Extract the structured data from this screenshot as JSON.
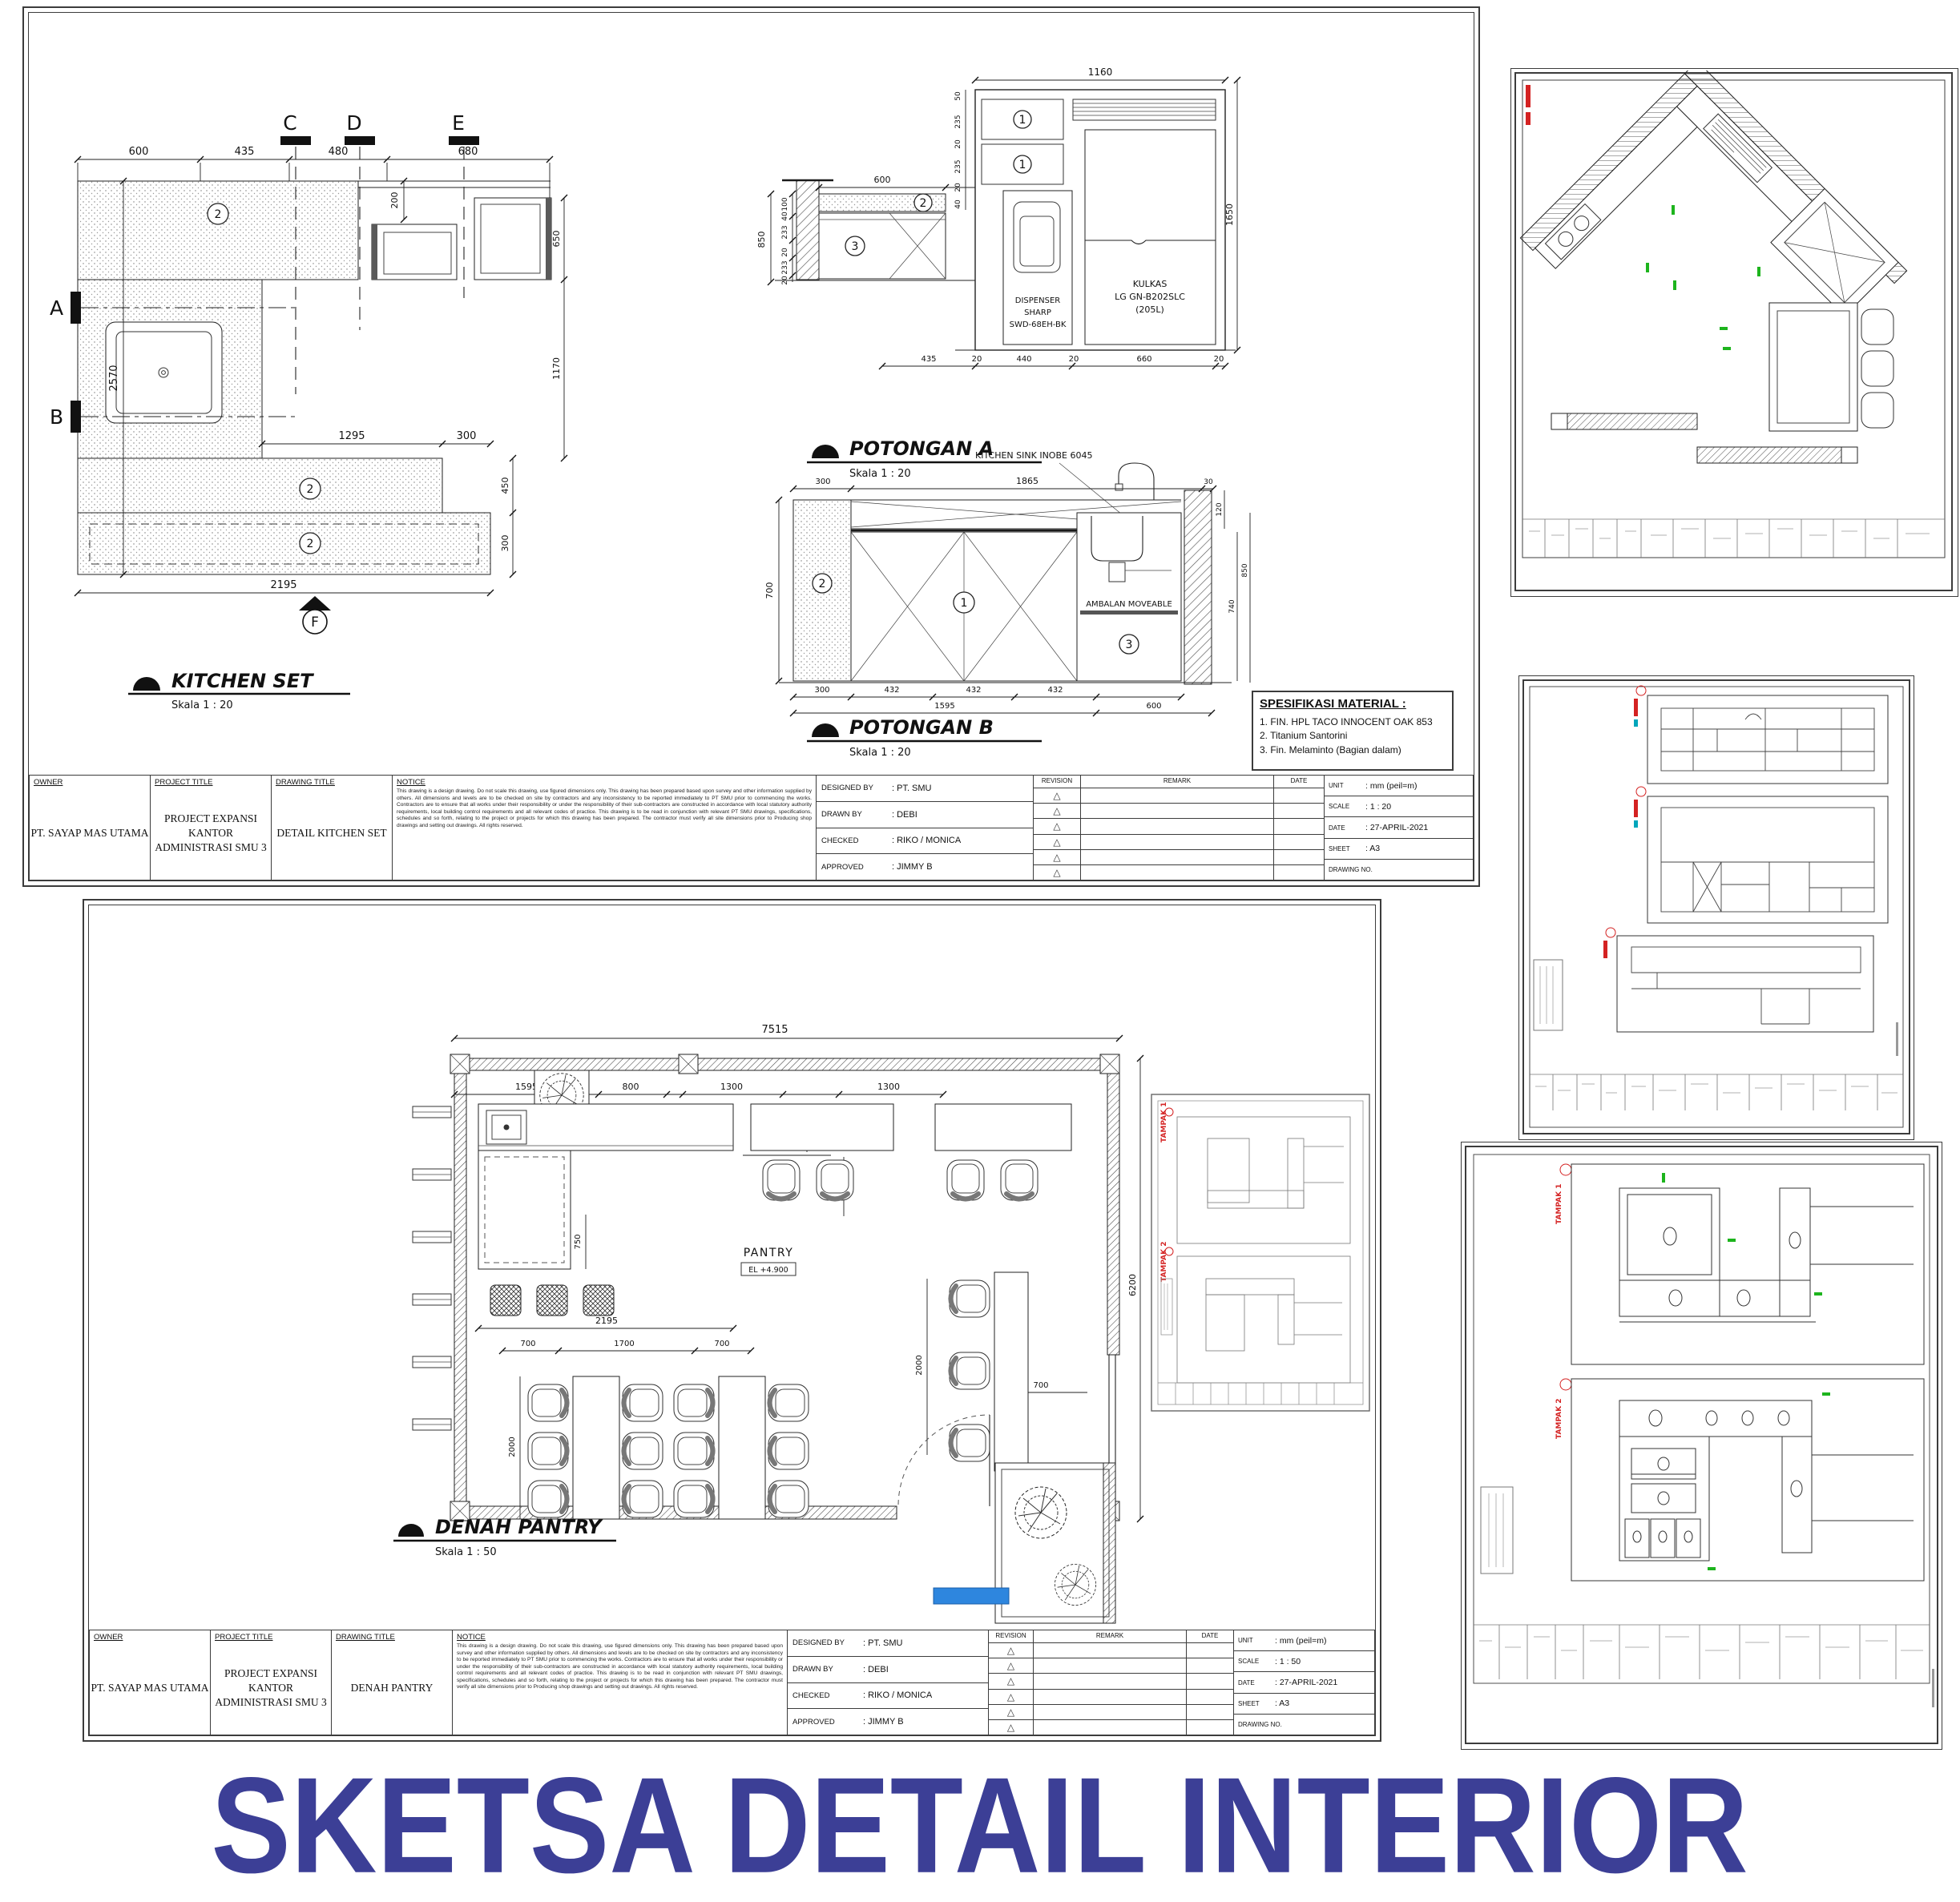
{
  "page": {
    "main_title": "SKETSA DETAIL INTERIOR"
  },
  "titleblock": {
    "labels": {
      "owner": "OWNER",
      "project_title": "PROJECT TITLE",
      "drawing_title": "DRAWING TITLE",
      "notice": "NOTICE",
      "designed_by": "DESIGNED BY",
      "drawn_by": "DRAWN BY",
      "checked": "CHECKED",
      "approved": "APPROVED",
      "revision": "REVISION",
      "remark": "REMARK",
      "date": "DATE",
      "unit": "UNIT",
      "scale": "SCALE",
      "sheet": "SHEET",
      "drawing_no": "DRAWING NO."
    },
    "owner": "PT. SAYAP MAS UTAMA",
    "project_line1": "PROJECT EXPANSI",
    "project_line2": "KANTOR ADMINISTRASI SMU 3",
    "designed_by": ": PT. SMU",
    "drawn_by": ": DEBI",
    "checked": ": RIKO / MONICA",
    "approved": ": JIMMY B",
    "unit_value": ": mm (peil=m)",
    "date_value": ": 27-APRIL-2021",
    "sheet_value": ": A3",
    "notice_text": "This drawing is a design drawing. Do not scale this drawing, use figured dimensions only. This drawing has been prepared based upon survey and other information supplied by others. All dimensions and levels are to be checked on site by contractors and any inconsistency to be reported immediately to PT SMU prior to commencing the works. Contractors are to ensure that all works under their responsibility or under the responsibility of their sub-contractors are constructed in accordance with local statutory authority requirements, local building control requirements and all relevant codes of practice. This drawing is to be read in conjunction with relevant PT SMU drawings, specifications, schedules and so forth, relating to the project or projects for which this drawing has been prepared. The contractor must verify all site dimensions prior to Producing shop drawings and setting out drawings. All rights reserved."
  },
  "sheet1": {
    "drawing_title": "DETAIL KITCHEN SET",
    "scale_value": ": 1 : 20",
    "kitchen": {
      "title": "KITCHEN SET",
      "scale": "Skala 1 : 20",
      "dim_600": "600",
      "dim_435": "435",
      "dim_480": "480",
      "dim_680": "680",
      "dim_200": "200",
      "dim_650": "650",
      "dim_1170": "1170",
      "dim_2570": "2570",
      "dim_1295": "1295",
      "dim_300a": "300",
      "dim_450": "450",
      "dim_300b": "300",
      "dim_2195": "2195",
      "mk_a": "A",
      "mk_b": "B",
      "mk_c": "C",
      "mk_d": "D",
      "mk_e": "E",
      "mk_f": "F",
      "tag2": "2"
    },
    "pot_a": {
      "title": "POTONGAN A",
      "scale": "Skala 1 : 20",
      "dim_1160": "1160",
      "dim_1650": "1650",
      "dim_600": "600",
      "dim_435": "435",
      "stack_left": [
        "100",
        "40",
        "233",
        "20",
        "233",
        "20"
      ],
      "dim_850": "850",
      "stack_right": [
        "50",
        "235",
        "20",
        "235",
        "20",
        "40"
      ],
      "bottom": [
        "435",
        "20",
        "440",
        "20",
        "660",
        "20"
      ],
      "tag1": "1",
      "tag2": "2",
      "tag3": "3",
      "dispenser": [
        "DISPENSER",
        "SHARP",
        "SWD-68EH-BK"
      ],
      "kulkas": [
        "KULKAS",
        "LG GN-B202SLC",
        "(205L)"
      ]
    },
    "pot_b": {
      "title": "POTONGAN B",
      "scale": "Skala 1 : 20",
      "sink_label": "KITCHEN SINK INOBE 6045",
      "shelf_label": "AMBALAN MOVEABLE",
      "dim_300": "300",
      "dim_1865": "1865",
      "dim_30": "30",
      "dim_700": "700",
      "dim_120": "120",
      "dim_740": "740",
      "dim_850": "850",
      "bottom": [
        "300",
        "432",
        "432",
        "432"
      ],
      "bottom2": [
        "1595",
        "600"
      ],
      "tag1": "1",
      "tag2": "2",
      "tag3": "3"
    },
    "spec": {
      "title": "SPESIFIKASI MATERIAL :",
      "items": [
        "1. FIN. HPL TACO INNOCENT OAK 853",
        "2. Titanium Santorini",
        "3. Fin. Melaminto (Bagian dalam)"
      ]
    }
  },
  "sheet2": {
    "drawing_title": "DENAH PANTRY",
    "scale_value": ": 1 : 50",
    "plan": {
      "title": "DENAH PANTRY",
      "scale": "Skala 1 : 50",
      "room": "PANTRY",
      "level": "EL +4.900",
      "dim_7515": "7515",
      "dim_6200": "6200",
      "dim_1595": "1595",
      "dim_800": "800",
      "dim_1300a": "1300",
      "dim_700a": "700",
      "dim_1300b": "1300",
      "dim_760": "760",
      "dim_1051": "1051",
      "dim_1170": "1170",
      "dim_750": "750",
      "dim_2195": "2195",
      "dim_700b": "700",
      "dim_1700": "1700",
      "dim_700c": "700",
      "dim_2000a": "2000",
      "dim_2000b": "2000",
      "dim_700d": "700"
    }
  },
  "tampak": {
    "t1": "TAMPAK 1",
    "t2": "TAMPAK 2"
  }
}
